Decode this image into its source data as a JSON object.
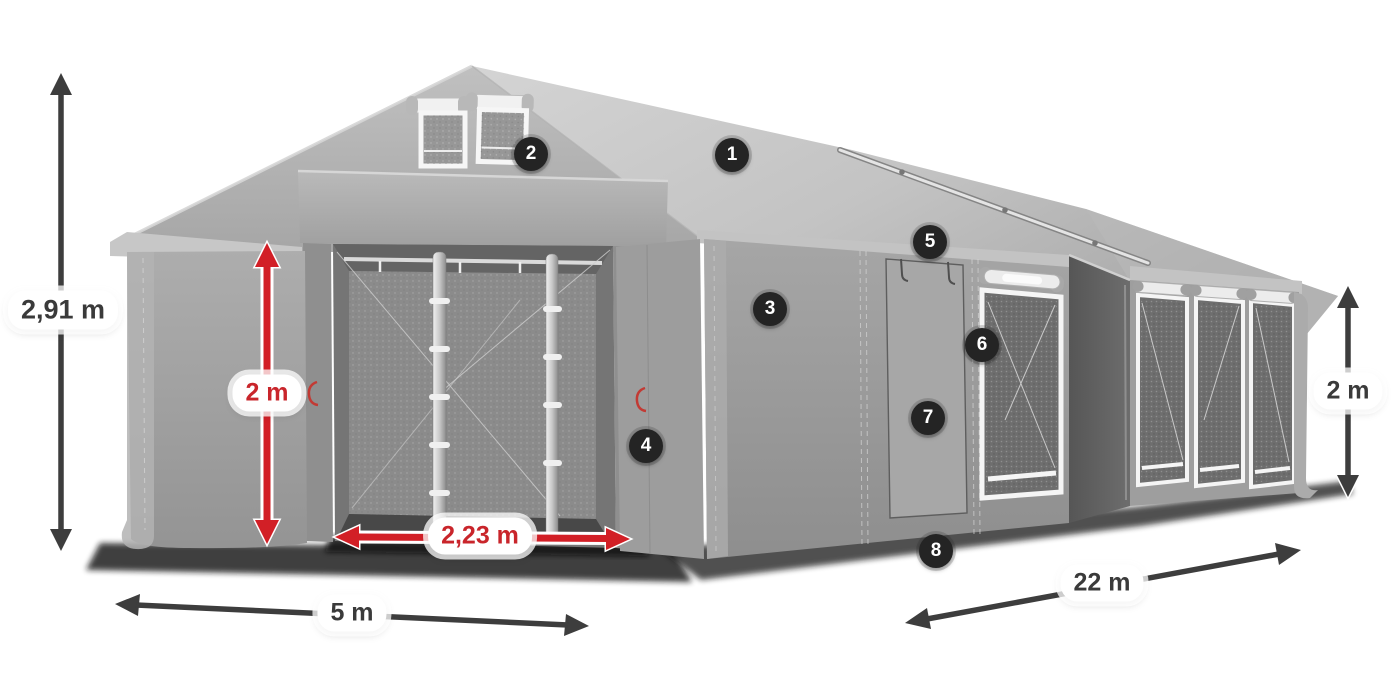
{
  "figure": {
    "type": "product-dimension-diagram",
    "subject": "Gray marquee storage tent with open front entrance, side door and mesh windows"
  },
  "dimensions": {
    "height_left": {
      "label": "2,91 m",
      "style": "dark"
    },
    "front_width": {
      "label": "5 m",
      "style": "dark"
    },
    "side_length": {
      "label": "22 m",
      "style": "dark"
    },
    "side_height": {
      "label": "2 m",
      "style": "dark"
    },
    "door_height": {
      "label": "2 m",
      "style": "red"
    },
    "door_width": {
      "label": "2,23 m",
      "style": "red"
    }
  },
  "badges": [
    {
      "label": "1"
    },
    {
      "label": "2"
    },
    {
      "label": "3"
    },
    {
      "label": "4"
    },
    {
      "label": "5"
    },
    {
      "label": "6"
    },
    {
      "label": "7"
    },
    {
      "label": "8"
    }
  ],
  "colors": {
    "background": "#ffffff",
    "arrow_dark": "#3d3d3d",
    "arrow_red": "#d21f26",
    "badge_bg": "#242424",
    "badge_text": "#ffffff",
    "label_text_dark": "#3a3a3a",
    "label_text_red": "#c9252b",
    "tent_roof": "#c9c9c9",
    "tent_wall": "#9d9d9d",
    "tent_interior": "#757575",
    "window_frame": "#f5f5f5"
  }
}
